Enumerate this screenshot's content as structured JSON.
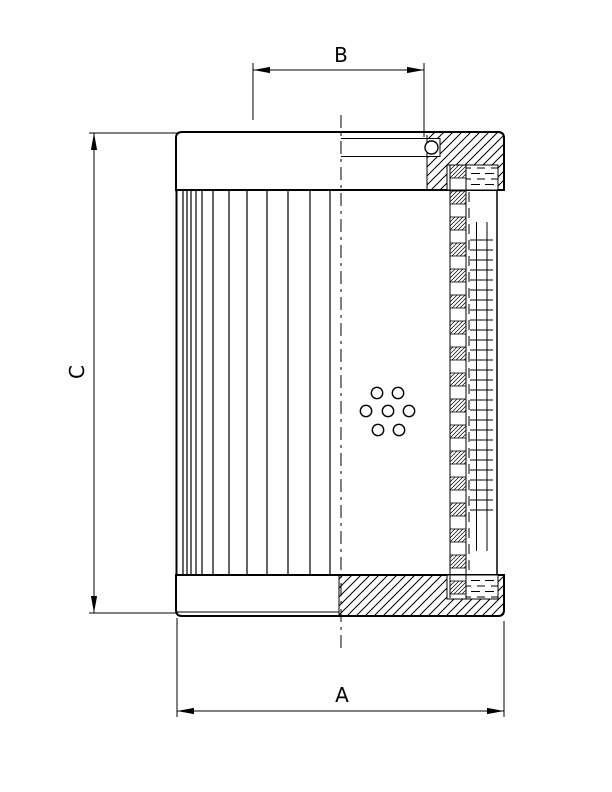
{
  "drawing": {
    "type": "technical-section-drawing",
    "subject": "filter-element-cross-section",
    "colors": {
      "ink": "#000000",
      "paper": "#ffffff"
    },
    "labels": {
      "a": "A",
      "b": "B",
      "c": "C"
    },
    "geometry": {
      "pleats": {
        "x_positions": [
          183,
          187,
          191,
          196,
          202,
          213,
          229,
          247,
          267,
          288,
          310,
          330
        ],
        "y_top": 190,
        "y_bottom": 575
      },
      "holes": {
        "centers": [
          [
            377,
            393
          ],
          [
            398,
            393
          ],
          [
            366,
            411
          ],
          [
            388,
            411
          ],
          [
            409,
            411
          ],
          [
            378,
            430
          ],
          [
            399,
            430
          ]
        ],
        "radius": 5.7
      },
      "mesh": {
        "rung_y_start": 240,
        "rung_y_end": 515,
        "rung_step": 10,
        "rung_x1": 470,
        "rung_x2": 493,
        "wire_xs": [
          476.5,
          487
        ],
        "wire_y_top": 222,
        "wire_y_bottom": 551
      },
      "core_tube": {
        "x": 450,
        "width": 16,
        "y_top": 165,
        "y_bottom": 598,
        "pitch": 26,
        "segment_height": 13
      }
    }
  }
}
